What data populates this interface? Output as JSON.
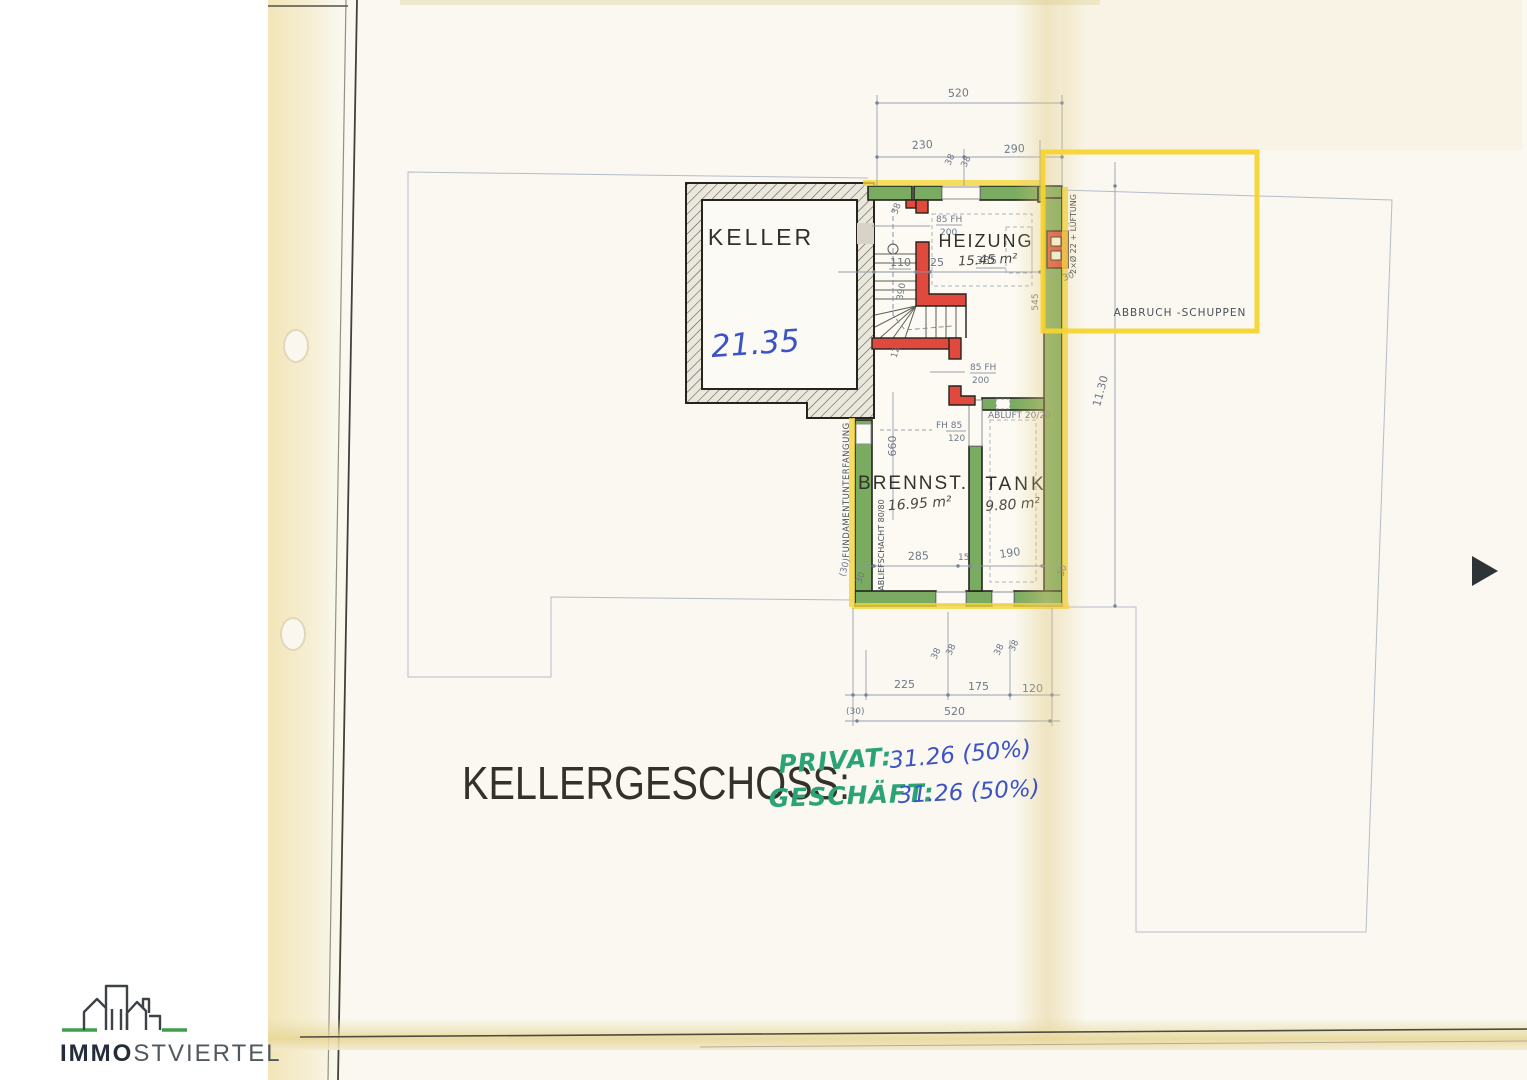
{
  "title": "KELLERGESCHOSS:",
  "annotations": {
    "privat_label": "PRIVAT:",
    "privat_value": "31.26 (50%)",
    "geschaeft_label": "GESCHÄFT:",
    "geschaeft_value": "31.26 (50%)"
  },
  "rooms": {
    "keller": {
      "name": "KELLER",
      "handwritten_area": "21.35"
    },
    "heizung": {
      "name": "HEIZUNG",
      "area": "15.45 m²"
    },
    "brennstoff": {
      "name": "BRENNST.",
      "area": "16.95 m²"
    },
    "tank": {
      "name": "TANK",
      "area": "9.80 m²"
    }
  },
  "labels": {
    "abbruch_schuppen": "ABBRUCH -SCHUPPEN",
    "fundamentunterfangung": "FUNDAMENTUNTERFANGUNG",
    "abliefschacht": "ABLIEFSCHACHT 80/80",
    "abluft": "ABLUFT 20/20",
    "kamin_lueftung": "2×Ø 22 + LÜFTUNG",
    "tuer_oben_mass": "85 FH",
    "tuer_oben_hoehe": "200",
    "tuer_mitte_mass": "85 FH",
    "tuer_mitte_hoehe": "200",
    "fenster_mass": "FH 85",
    "fenster_hoehe": "120"
  },
  "dimensions": {
    "top": {
      "gesamt": "520",
      "links": "230",
      "rechts": "290",
      "wand_a": "38",
      "wand_b": "38"
    },
    "innen": {
      "wand_oben": "38",
      "stiege": "110",
      "wand": "25",
      "heizung_breite": "385",
      "wand_rechts": "30",
      "heizung_tiefe": "545",
      "stiege_lauf": "390",
      "wand_12": "12",
      "brennstoff_tiefe": "660",
      "brennstoff_breite": "285",
      "zwischenwand": "15",
      "tank_breite": "190",
      "wand_sued_rechts": "30",
      "wand_sued_links": "(30)",
      "wand_sued_links2": "30"
    },
    "rechts": {
      "laenge": "11.30"
    },
    "unten": {
      "wand_a": "38",
      "wand_b": "38",
      "wand_c": "38",
      "wand_d": "38",
      "links": "225",
      "mitte": "175",
      "rechts": "120",
      "klammer": "(30)",
      "gesamt": "520"
    }
  },
  "logo": {
    "brand_bold": "IMMO",
    "brand_light": "STVIERTEL"
  }
}
